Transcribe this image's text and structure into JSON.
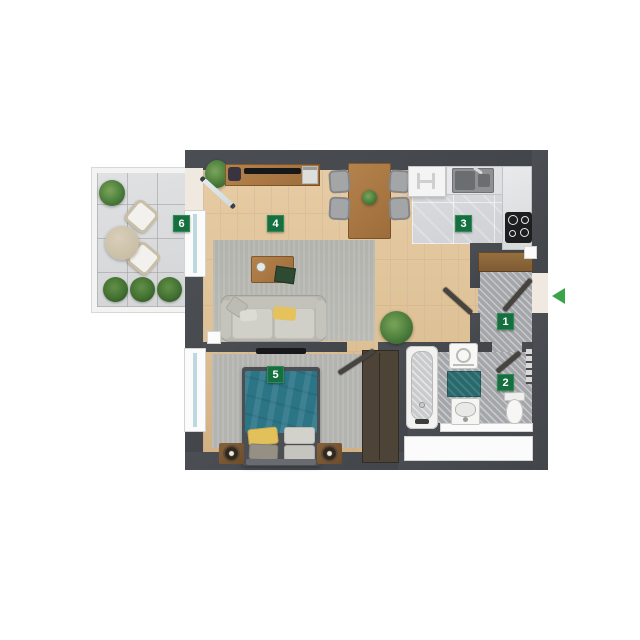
{
  "plan": {
    "type": "apartment-floor-plan",
    "rooms": [
      {
        "number": "1",
        "name": "hallway"
      },
      {
        "number": "2",
        "name": "bathroom"
      },
      {
        "number": "3",
        "name": "kitchen"
      },
      {
        "number": "4",
        "name": "living-room"
      },
      {
        "number": "5",
        "name": "bedroom"
      },
      {
        "number": "6",
        "name": "balcony"
      }
    ],
    "entrance_arrow": {
      "direction": "left",
      "color": "#3aa44b"
    },
    "room_label_style": {
      "background": "#156f3e",
      "text": "#ffffff"
    },
    "palette": {
      "wall": "#46494d",
      "wood_floor": "#e3c69e",
      "bedroom_wood_floor": "#d9ba8e",
      "kitchen_tile": "#d8d9db",
      "hatch_floor": "#a4a6a9",
      "balcony_tile": "#dcdddf",
      "rug": "#b9bab4",
      "bed_teal": "#2b7587",
      "bath_mat_teal": "#27696c",
      "pillow_yellow": "#e4c35c",
      "furniture_wood": "#a97c4a",
      "plant_green": "#4c7d3c"
    },
    "furniture": {
      "living_room": [
        "tv-sideboard",
        "tv",
        "plant",
        "dining-table",
        "dining-chairs",
        "rug",
        "coffee-table",
        "sofa"
      ],
      "kitchen": [
        "fridge",
        "double-sink",
        "counter",
        "cooktop"
      ],
      "hallway": [
        "wardrobe"
      ],
      "bedroom": [
        "double-bed",
        "nightstand-lamps",
        "wardrobe",
        "wall-tv",
        "rug",
        "window"
      ],
      "bathroom": [
        "bathtub",
        "washing-machine",
        "bath-mat",
        "vanity-sink",
        "toilet",
        "towel-radiator",
        "window"
      ],
      "balcony": [
        "lounge-chair",
        "lounge-chair",
        "round-table",
        "potted-plant",
        "bushes"
      ]
    }
  }
}
